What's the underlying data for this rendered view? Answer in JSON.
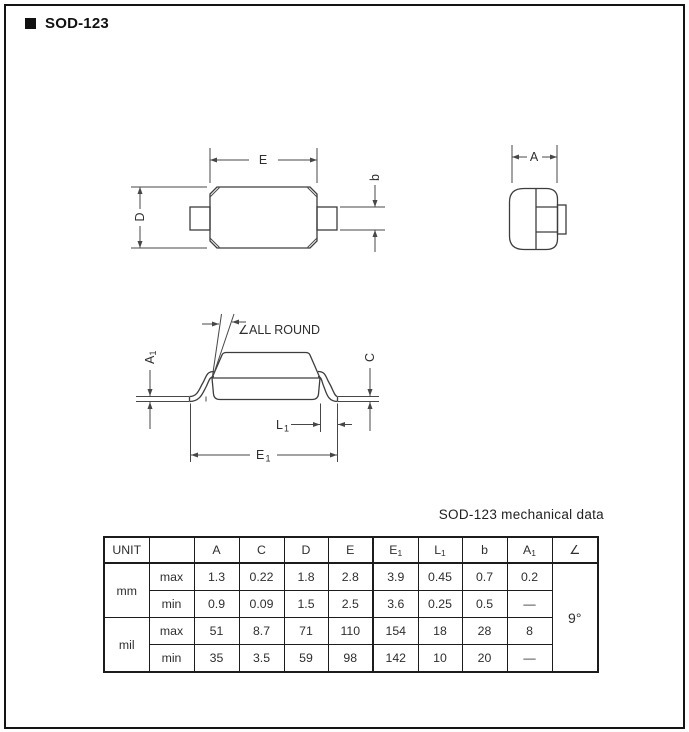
{
  "colors": {
    "page_background": "#ffffff",
    "frame_border": "#141414",
    "drawing_lines": "#474747",
    "text": "#2e2e2e",
    "table_border": "#1c1c1c"
  },
  "header": {
    "marker": "■",
    "title": "SOD-123"
  },
  "drawing": {
    "top_view": {
      "dim_e": "E",
      "dim_d": "D",
      "dim_b": "b"
    },
    "end_view": {
      "dim_a": "A"
    },
    "side_view": {
      "angle_note": {
        "symbol": "∠",
        "text": "ALL ROUND"
      },
      "dim_a1": {
        "base": "A",
        "sub": "1"
      },
      "dim_c": "C",
      "dim_l1": {
        "base": "L",
        "sub": "1"
      },
      "dim_e1": {
        "base": "E",
        "sub": "1"
      }
    }
  },
  "table": {
    "title": "SOD-123 mechanical data",
    "col_headers": {
      "unit": "UNIT",
      "blank": "",
      "a": "A",
      "c": "C",
      "d": "D",
      "e": "E",
      "e1": {
        "base": "E",
        "sub": "1"
      },
      "l1": {
        "base": "L",
        "sub": "1"
      },
      "b": "b",
      "a1": {
        "base": "A",
        "sub": "1"
      },
      "angle": "∠"
    },
    "rows": [
      {
        "unit": "mm",
        "limit": "max",
        "values": [
          "1.3",
          "0.22",
          "1.8",
          "2.8",
          "3.9",
          "0.45",
          "0.7",
          "0.2"
        ]
      },
      {
        "limit": "min",
        "values": [
          "0.9",
          "0.09",
          "1.5",
          "2.5",
          "3.6",
          "0.25",
          "0.5",
          "—"
        ]
      },
      {
        "unit": "mil",
        "limit": "max",
        "values": [
          "51",
          "8.7",
          "71",
          "110",
          "154",
          "18",
          "28",
          "8"
        ]
      },
      {
        "limit": "min",
        "values": [
          "35",
          "3.5",
          "59",
          "98",
          "142",
          "10",
          "20",
          "—"
        ]
      }
    ],
    "angle_value": "9°"
  }
}
